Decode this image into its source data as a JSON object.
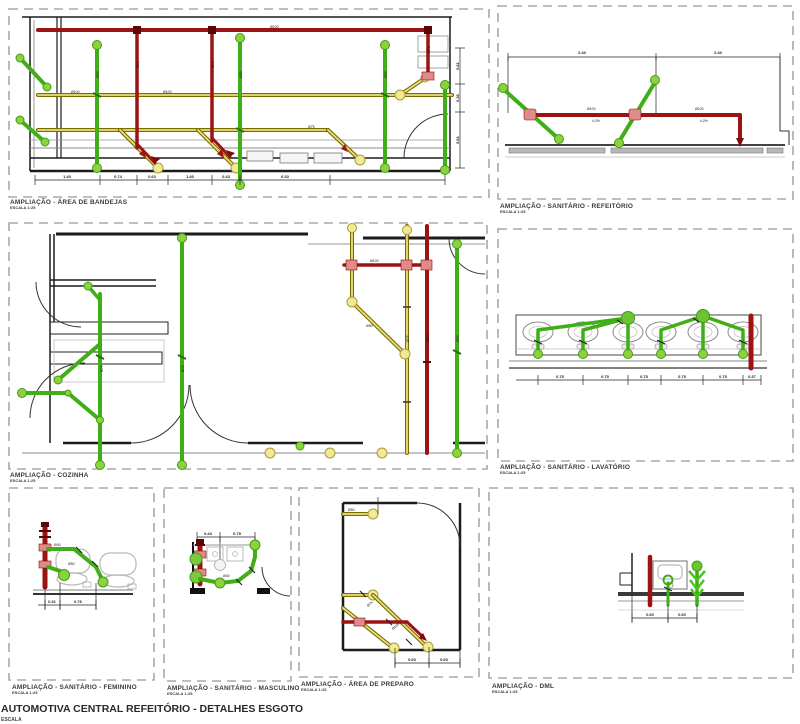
{
  "footer": {
    "title": "AUTOMOTIVA CENTRAL REFEITÓRIO - DETALHES ESGOTO",
    "subtitle": "ESCALA"
  },
  "colors": {
    "pipe_red": "#9b1313",
    "pipe_red_dark": "#5c0707",
    "pipe_green": "#3fae17",
    "pipe_green_light": "#8ed13e",
    "pipe_olive": "#7a6c00",
    "pipe_olive_fill": "#e9e07c",
    "fitting_pink": "#e08a8a",
    "wall": "#1c1c1c",
    "floor_gray": "#b0b0b0",
    "panel_border": "#a8a8a8"
  },
  "pipe_labels": {
    "d100": "Ø100",
    "d75": "Ø75",
    "d50": "Ø50",
    "d40": "Ø40",
    "slope": "i=2%"
  },
  "panels": [
    {
      "id": "bandejas",
      "title": "AMPLIAÇÃO - ÁREA DE BANDEJAS",
      "scale": "ESCALA 1:25",
      "dims": [
        "1.40",
        "0.74",
        "0.63",
        "1.40",
        "0.43",
        "0.33"
      ],
      "dims_right": [
        "0.61",
        "0.36",
        "0.61"
      ]
    },
    {
      "id": "sanitario-refeitorio",
      "title": "AMPLIAÇÃO - SANITÁRIO - REFEITÓRIO",
      "scale": "ESCALA 1:25",
      "dims": [
        "2.40",
        "2.40"
      ]
    },
    {
      "id": "cozinha",
      "title": "AMPLIAÇÃO - COZINHA",
      "scale": "ESCALA 1:25",
      "dims": []
    },
    {
      "id": "lavatorio",
      "title": "AMPLIAÇÃO - SANITÁRIO - LAVATÓRIO",
      "scale": "ESCALA 1:25",
      "dims": [
        "0.75",
        "0.75",
        "0.75",
        "0.75",
        "0.75",
        "0.37"
      ]
    },
    {
      "id": "feminino",
      "title": "AMPLIAÇÃO - SANITÁRIO - FEMININO",
      "scale": "ESCALA 1:25",
      "dims": [
        "0.31",
        "0.76"
      ]
    },
    {
      "id": "masculino",
      "title": "AMPLIAÇÃO - SANITÁRIO - MASCULINO",
      "scale": "ESCALA 1:25",
      "dims": [
        "0.43",
        "0.75"
      ]
    },
    {
      "id": "preparo",
      "title": "AMPLIAÇÃO - ÁREA DE PREPARO",
      "scale": "ESCALA 1:25",
      "dims": [
        "0.60",
        "0.60"
      ]
    },
    {
      "id": "dml",
      "title": "AMPLIAÇÃO - DML",
      "scale": "ESCALA 1:25",
      "dims": [
        "0.60",
        "0.60"
      ]
    }
  ]
}
